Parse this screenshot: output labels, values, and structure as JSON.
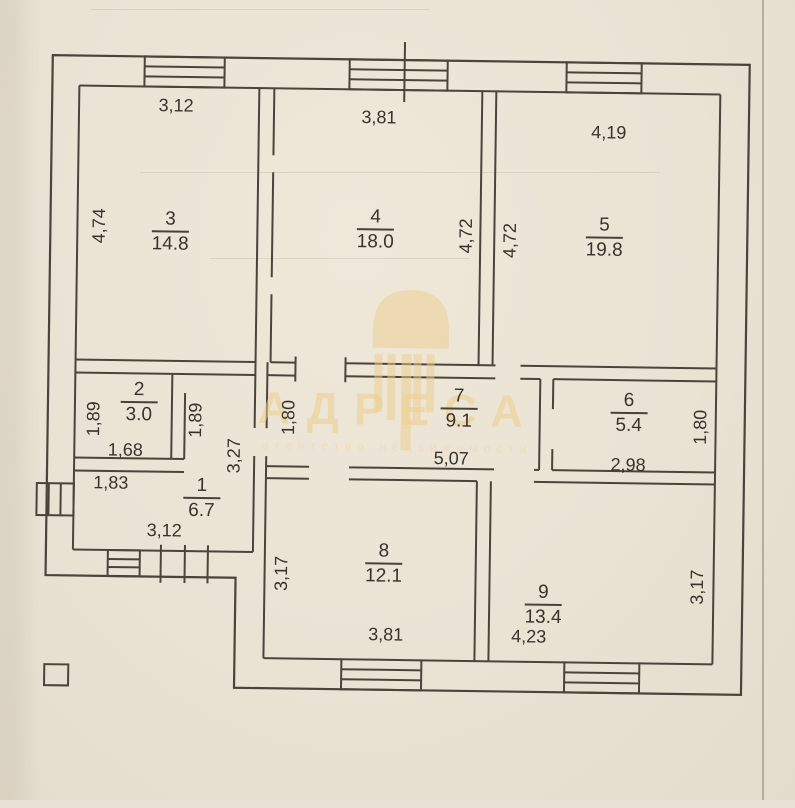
{
  "watermark": {
    "brand": "АДРЕСА",
    "subtitle": "агентство недвижимости"
  },
  "rooms": [
    {
      "number": "1",
      "area": "6.7",
      "dim_bottom": "3,12",
      "dim_right": "3,27",
      "dim_top": "1,83"
    },
    {
      "number": "2",
      "area": "3.0",
      "dim_left": "1,89",
      "dim_bottom": "1,68",
      "dim_right": "1,89"
    },
    {
      "number": "3",
      "area": "14.8",
      "dim_top": "3,12",
      "dim_left": "4,74"
    },
    {
      "number": "4",
      "area": "18.0",
      "dim_top": "3,81",
      "dim_right": "4,72"
    },
    {
      "number": "5",
      "area": "19.8",
      "dim_top": "4,19",
      "dim_left": "4,72"
    },
    {
      "number": "6",
      "area": "5.4",
      "dim_bottom": "2,98",
      "dim_right": "1,80"
    },
    {
      "number": "7",
      "area": "9.1",
      "dim_left": "1,80",
      "dim_bottom": "5,07"
    },
    {
      "number": "8",
      "area": "12.1",
      "dim_left": "3,17",
      "dim_bottom": "3,81"
    },
    {
      "number": "9",
      "area": "13.4",
      "dim_bottom": "4,23",
      "dim_right": "3,17"
    }
  ]
}
